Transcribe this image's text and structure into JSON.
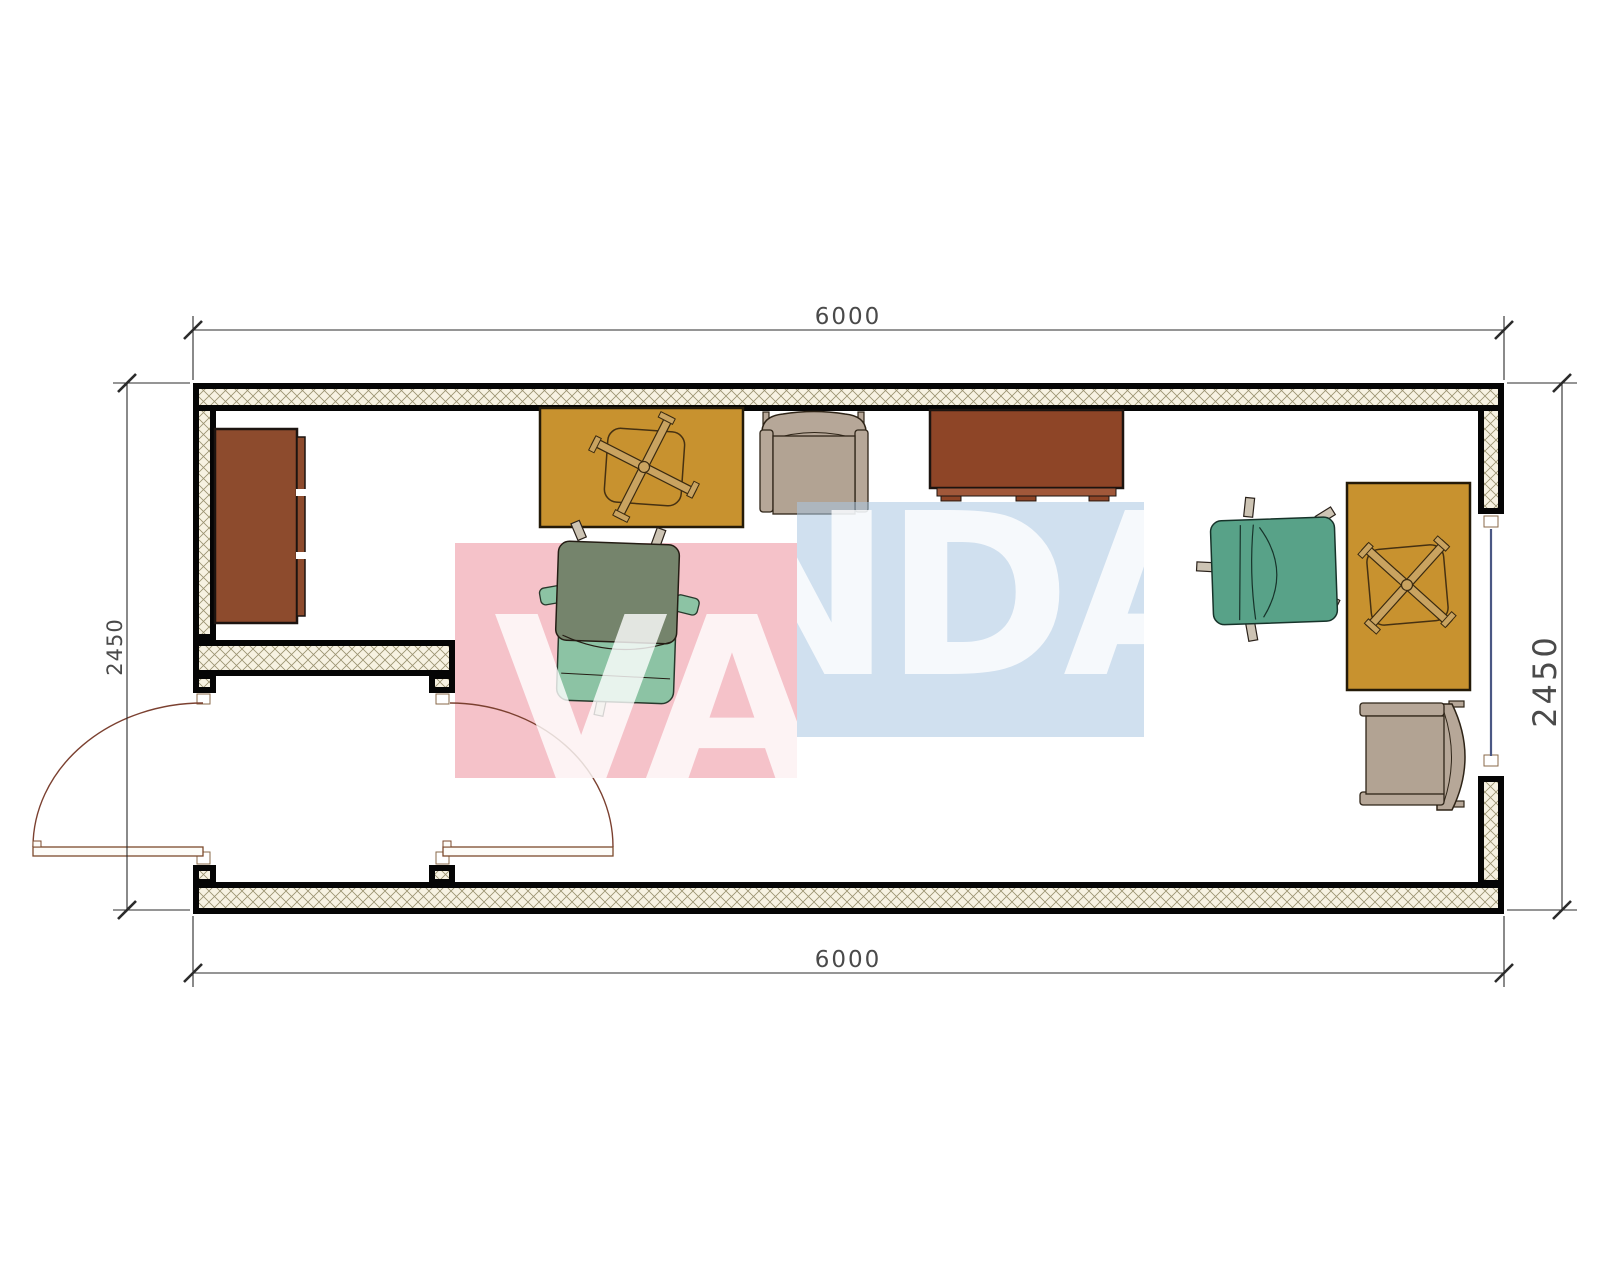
{
  "drawing": {
    "type": "architectural floor plan",
    "description": "container office plan view 6000 x 2450 mm"
  },
  "dimensions": {
    "top": "6000",
    "bottom": "6000",
    "left": "2450",
    "right": "2450"
  },
  "watermark": {
    "text": "VANDA",
    "pink_color": "#f5c2c9",
    "blue_color": "#aac6e2"
  },
  "palette": {
    "desk": "#c8922f",
    "desk_border": "#241a08",
    "cabinet": "#8d4b2d",
    "sideboard": "#8e4527",
    "sideboard_strip": "#a1583a",
    "armchair": "#b6a798",
    "armchair_seat": "#b2a393",
    "chair_back_sage": "#75846c",
    "chair_seat_mint": "#8cc3a4",
    "chair_teal": "#58a288",
    "wall_hatch_bg": "#f7f2e2",
    "wall_hatch_line": "#9a9270",
    "wall_line": "#050505",
    "window_glass": "#4a5784",
    "door_line": "#7b4030",
    "dimension_line": "#2b2b2b",
    "dimension_text": "#4a4a4a",
    "xbase_fill": "#c9a360"
  },
  "furniture_items": [
    {
      "label": "cabinet"
    },
    {
      "label": "desk-left"
    },
    {
      "label": "office-chair-left"
    },
    {
      "label": "armchair-top"
    },
    {
      "label": "sideboard"
    },
    {
      "label": "office-chair-right"
    },
    {
      "label": "desk-right"
    },
    {
      "label": "armchair-right"
    },
    {
      "label": "double-entry-doors"
    },
    {
      "label": "window"
    }
  ]
}
